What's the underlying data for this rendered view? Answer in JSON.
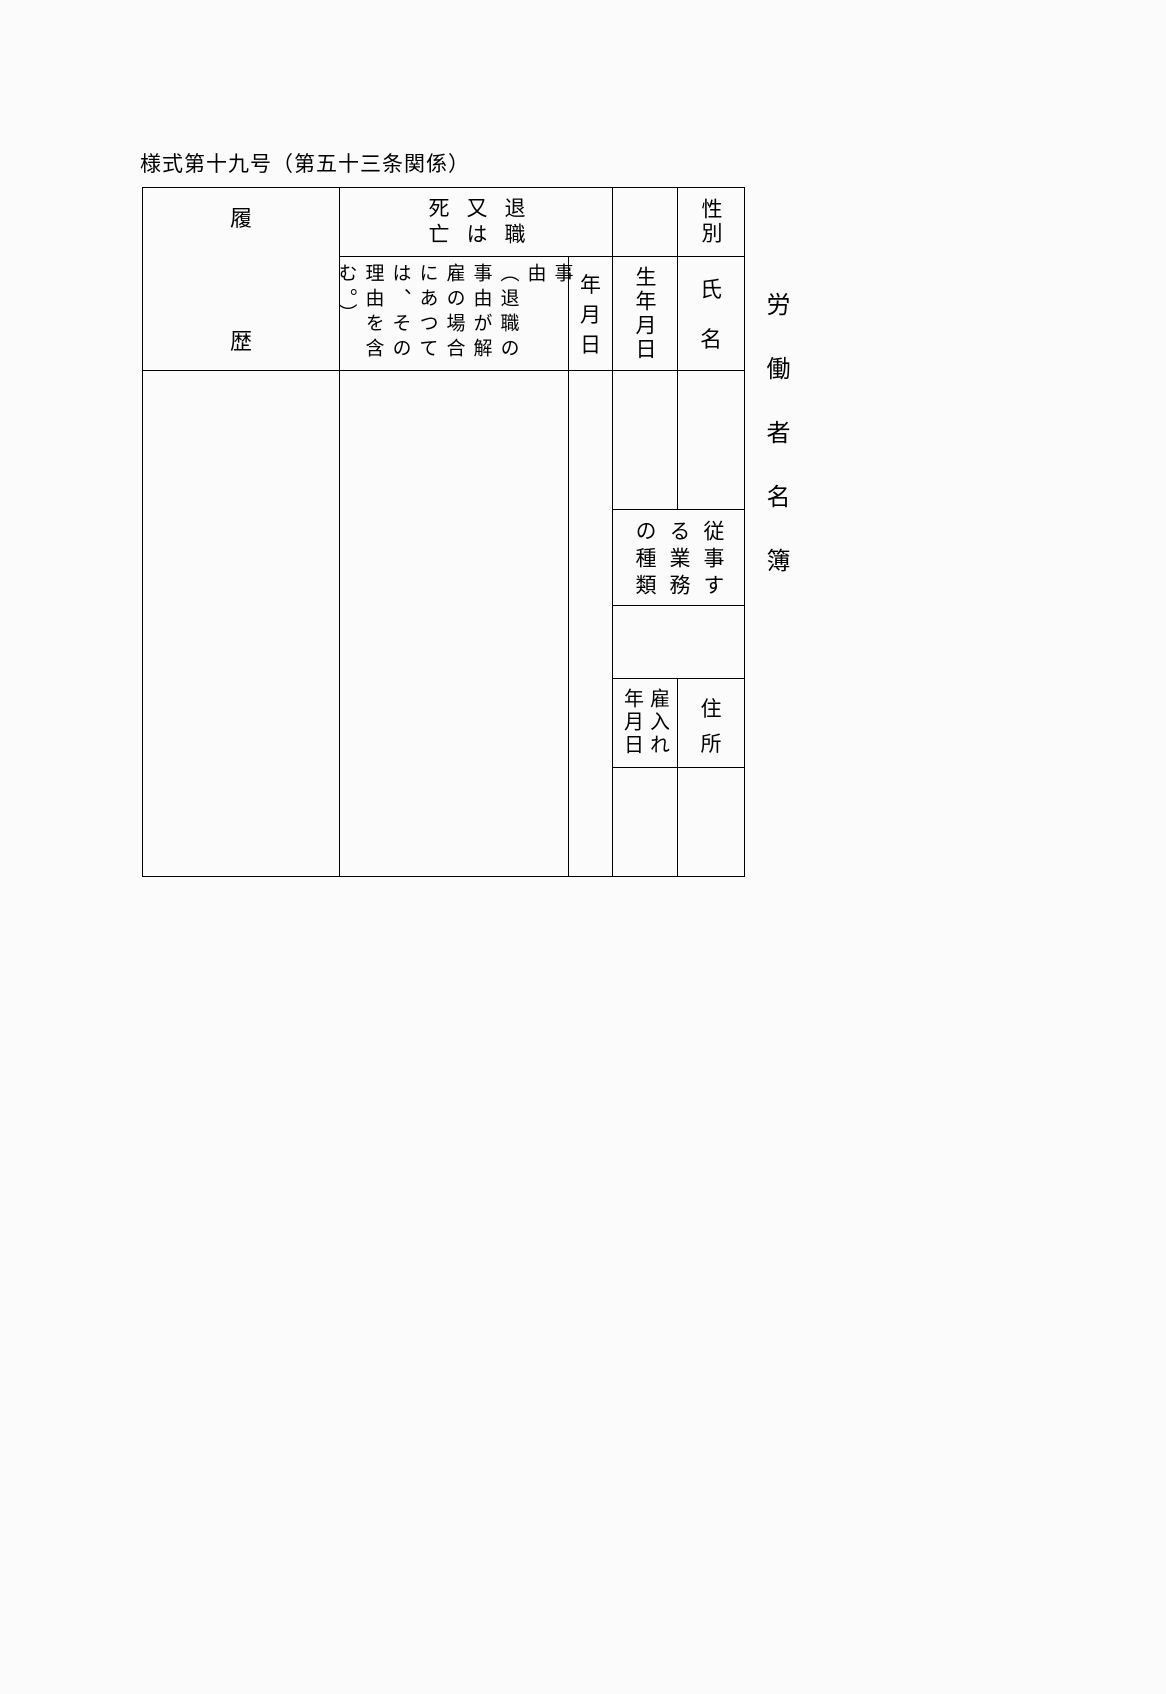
{
  "colors": {
    "background": "#fbfbfb",
    "line": "#000000",
    "text": "#000000"
  },
  "title": "様式第十九号（第五十三条関係）",
  "side_label": {
    "text": "労働者名簿"
  },
  "table": {
    "history_header": {
      "top": "履",
      "bottom": "歴"
    },
    "retirement_header": {
      "cols": [
        "退職",
        "又は",
        "死亡"
      ]
    },
    "gender_header": {
      "text": "性別"
    },
    "reason_note": {
      "cols": [
        "事由",
        "（退職の",
        "事由が解",
        "雇の場合",
        "にあつて",
        "は、その",
        "理由を含",
        "む。）"
      ]
    },
    "date_header": {
      "chars": [
        "年",
        "月",
        "日"
      ]
    },
    "birthdate_header": {
      "text": "生年月日"
    },
    "name_header": {
      "top": "氏",
      "bottom": "名"
    },
    "work_header": {
      "cols": [
        "従事す",
        "る業務",
        "の種類"
      ]
    },
    "hire_date_header": {
      "cols": [
        "雇入れ",
        "年月日"
      ]
    },
    "address_header": {
      "top": "住",
      "bottom": "所"
    }
  }
}
